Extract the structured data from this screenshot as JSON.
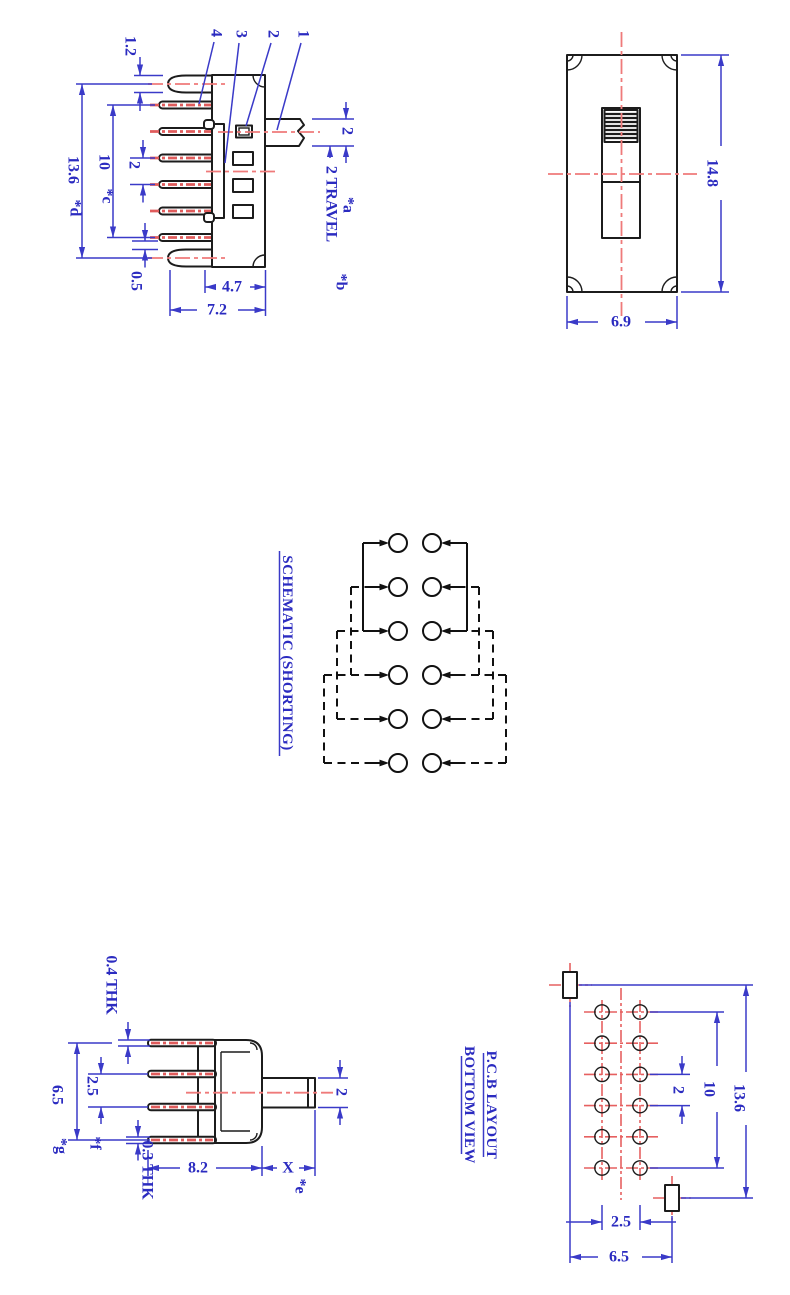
{
  "colors": {
    "dimension_blue": "#2b2bc0",
    "centerline_red": "#ef7a7a",
    "outline_black": "#1c1c1c"
  },
  "side_view": {
    "callouts": {
      "terminal": "4",
      "cover": "3",
      "housing": "2",
      "actuator": "1"
    },
    "dim_lug_thickness": "1.2",
    "dim_total_height": "13.6",
    "ref_total_height": "*d",
    "dim_terminal_span": "10",
    "ref_terminal_span": "*c",
    "dim_terminal_pitch": "2",
    "dim_lug_gap": "0.5",
    "dim_body_width": "4.7",
    "ref_body_width": "*b",
    "dim_overall_width": "7.2",
    "dim_actuator_thickness": "2",
    "dim_travel": "2 TRAVEL",
    "ref_travel": "*a"
  },
  "top_view": {
    "dim_length": "14.8",
    "dim_width": "6.9"
  },
  "schematic": {
    "title": "SCHEMATIC (SHORTING)",
    "columns": 2,
    "rows": [
      "open",
      "open",
      "closed",
      "closed",
      "open",
      "open"
    ]
  },
  "end_view": {
    "dim_tab_thickness": "0.4 THK",
    "dim_height": "6.5",
    "ref_height": "*g",
    "dim_terminal_pitch": "2.5",
    "ref_terminal_pitch": "*f",
    "dim_terminal_thickness": "0.3 THK",
    "dim_body_depth": "8.2",
    "dim_actuator_length": "X",
    "ref_actuator_length": "*e",
    "dim_actuator_thickness": "2"
  },
  "pcb_view": {
    "title_line1": "P.C.B LAYOUT",
    "title_line2": "BOTTOM VIEW",
    "hole_columns": 2,
    "hole_rows": 6,
    "dim_total_height": "13.6",
    "dim_hole_span": "10",
    "dim_hole_pitch": "2",
    "dim_column_pitch": "2.5",
    "dim_pad_span": "6.5"
  }
}
